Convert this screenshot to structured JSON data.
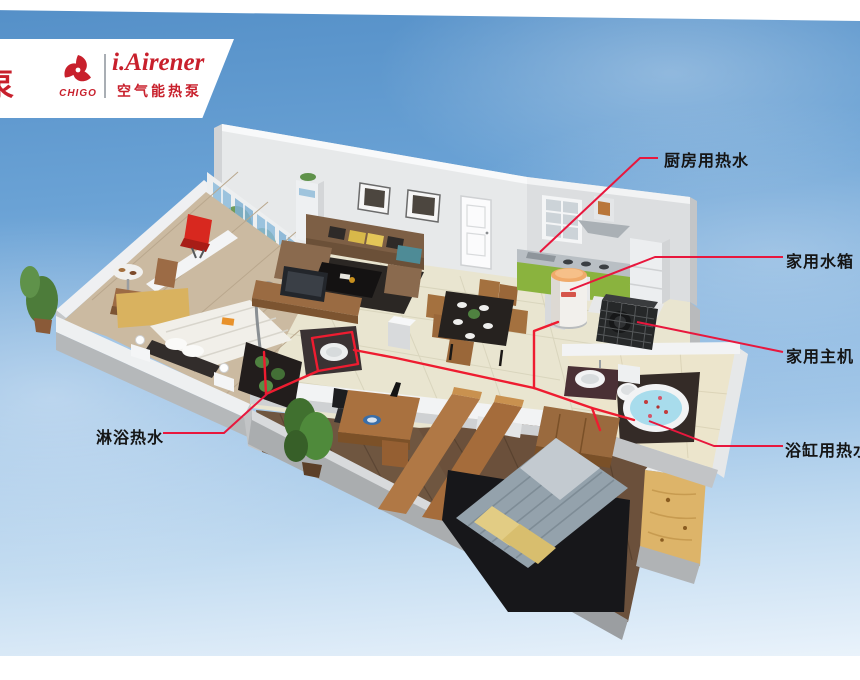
{
  "brand": {
    "partial_char": "泵",
    "chigo_label": "CHIGO",
    "product_name": "i.Airener",
    "product_subtitle": "空气能热泵",
    "brand_red": "#c8202c"
  },
  "callouts": {
    "kitchen": {
      "label": "厨房用热水"
    },
    "tank": {
      "label": "家用水箱"
    },
    "main_unit": {
      "label": "家用主机"
    },
    "bathtub": {
      "label": "浴缸用热水"
    },
    "shower": {
      "label": "淋浴热水"
    }
  },
  "palette": {
    "line_red": "#e81c3c",
    "sky_top": "#5590c8",
    "sky_bottom": "#eaf3fb",
    "wall_white": "#f1f2f3",
    "tile_floor": "#e9e5d0",
    "wood_dark": "#6f5640",
    "cabinet_green": "#8ab33e"
  }
}
